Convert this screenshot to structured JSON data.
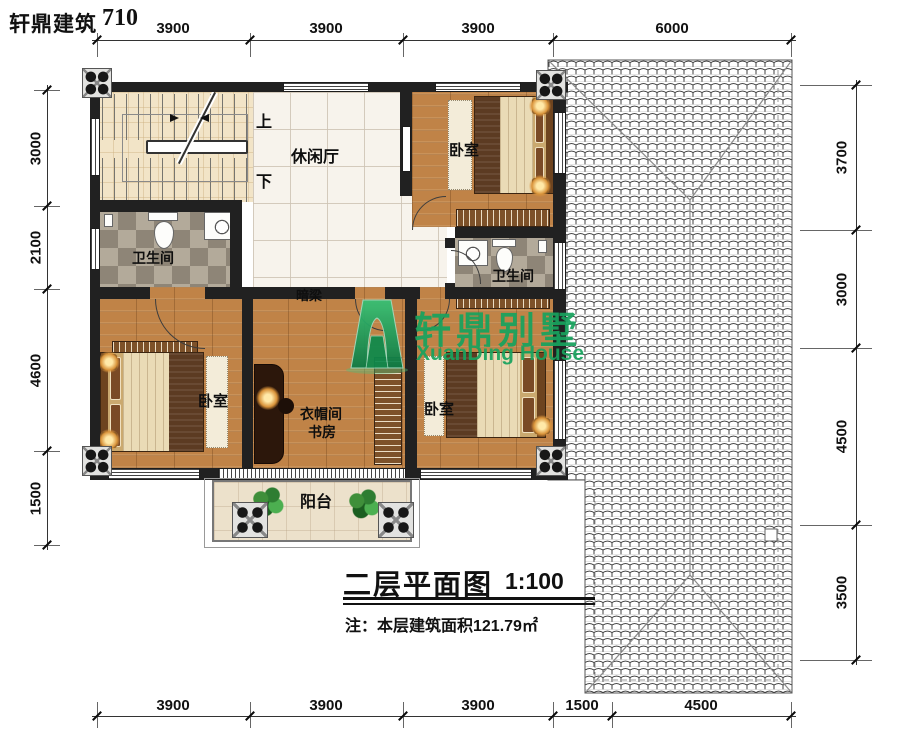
{
  "header": {
    "brand": "轩鼎建筑",
    "number": "710"
  },
  "dims": {
    "top": [
      "3900",
      "3900",
      "3900",
      "6000"
    ],
    "bottom": [
      "3900",
      "3900",
      "3900",
      "1500",
      "4500"
    ],
    "left": [
      "3000",
      "2100",
      "4600",
      "1500"
    ],
    "right": [
      "3700",
      "3000",
      "4500",
      "3500"
    ]
  },
  "rooms": {
    "leisure_hall": "休闲厅",
    "bedroom": "卧室",
    "bathroom": "卫生间",
    "cloakroom": "衣帽间",
    "study": "书房",
    "balcony": "阳台",
    "hidden_beam": "暗梁",
    "stairs_up": "上",
    "stairs_down": "下"
  },
  "watermark": {
    "cn": "轩鼎别墅",
    "en": "XuanDing House",
    "color": "#18a35e"
  },
  "title_block": {
    "title": "二层平面图",
    "scale": "1:100",
    "note": "注：本层建筑面积121.79㎡"
  },
  "colors": {
    "wall": "#212121",
    "wood": "#c08347",
    "marble": "#f7f3ec",
    "roof_line": "#2e2e2e",
    "watermark_green": "#18a35e"
  }
}
